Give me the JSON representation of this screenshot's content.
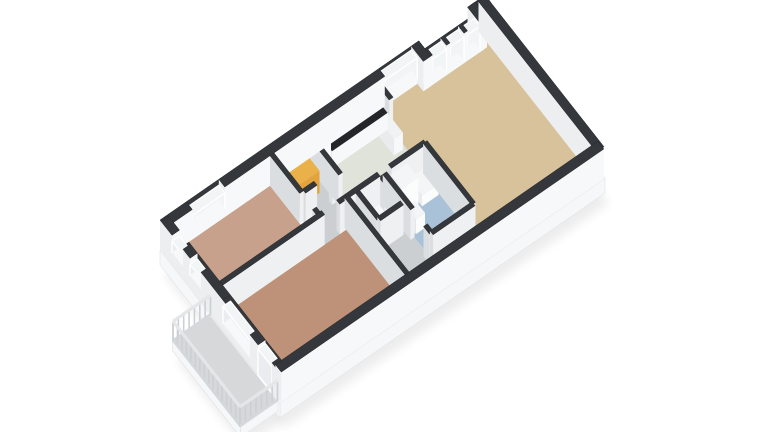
{
  "scene": {
    "width": 768,
    "height": 432,
    "origin": [
      160,
      250
    ],
    "ex": [
      25.0,
      -17.3
    ],
    "ey": [
      20.0,
      25.5
    ],
    "wall_height": 30,
    "colors": {
      "background": "#ffffff",
      "cap": "#34373b",
      "cap_stroke": "#26282b",
      "int_bright": "#eef0f2",
      "int_dim": "#dbdee0",
      "ext_bright": "#f7f8f9",
      "ext_dim": "#eceef0",
      "glass_bright": "#f2f5f6",
      "glass_dim": "#e9edef",
      "glass_frame": "#ffffff",
      "slab_top": "#ffffff",
      "slab_side": "#f6f7f8",
      "slab_edge": "#e2e3e5",
      "shadow": "#000000"
    }
  },
  "slabs": [
    {
      "n": "main-slab",
      "poly": [
        [
          0,
          0
        ],
        [
          10.2,
          0
        ],
        [
          10.2,
          0.45
        ],
        [
          12.45,
          0.45
        ],
        [
          12.45,
          0
        ],
        [
          13,
          0
        ],
        [
          13,
          6
        ],
        [
          0,
          6
        ]
      ],
      "depth": 15
    },
    {
      "n": "balcony-slab",
      "poly": [
        [
          -1.52,
          2.52
        ],
        [
          -0.02,
          2.52
        ],
        [
          -0.02,
          5.92
        ],
        [
          -1.52,
          5.92
        ]
      ],
      "depth": 10
    }
  ],
  "floors": [
    {
      "n": "floor-hallway",
      "r": [
        4.3,
        0.28,
        8.46,
        5.8
      ],
      "c": "#cbcfd2"
    },
    {
      "n": "floor-bedroom-1",
      "r": [
        0.3,
        0.3,
        4.16,
        2.6
      ],
      "c": "#c7a18b"
    },
    {
      "n": "floor-bedroom-2",
      "r": [
        0.3,
        2.76,
        5.24,
        5.78
      ],
      "c": "#bd9279"
    },
    {
      "n": "floor-kitchen",
      "r": [
        5.7,
        0.3,
        8.44,
        2.6
      ],
      "c": "#dfe3da"
    },
    {
      "n": "floor-wc",
      "r": [
        5.78,
        2.84,
        6.54,
        3.74
      ],
      "c": "#d6d9db"
    },
    {
      "n": "floor-bathroom",
      "r": [
        6.86,
        2.84,
        8.38,
        5.02
      ],
      "c": "#a9c2d8"
    },
    {
      "n": "floor-living-room",
      "r": [
        8.46,
        0.3,
        12.7,
        5.78
      ],
      "c": "#d8c29c"
    },
    {
      "n": "floor-balcony",
      "r": [
        -1.5,
        2.54,
        -0.04,
        5.9
      ],
      "c": "#d6d8da"
    }
  ],
  "walls": [
    {
      "n": "wall-back-a1",
      "a": [
        0,
        0.15
      ],
      "b": [
        1.05,
        0.15
      ],
      "t": 0.3,
      "ext": true
    },
    {
      "n": "wall-back-a2",
      "a": [
        2.35,
        0.15
      ],
      "b": [
        8.75,
        0.15
      ],
      "t": 0.3,
      "ext": true
    },
    {
      "n": "wall-back-a3",
      "a": [
        10.05,
        0.15
      ],
      "b": [
        10.35,
        0.15
      ],
      "t": 0.3,
      "ext": true
    },
    {
      "n": "wall-step-a",
      "a": [
        10.2,
        0.0
      ],
      "b": [
        10.2,
        0.6
      ],
      "t": 0.3,
      "ext": true
    },
    {
      "n": "wall-back-b0",
      "a": [
        10.2,
        0.45
      ],
      "b": [
        10.42,
        0.45
      ],
      "t": 0.3,
      "ext": true
    },
    {
      "n": "wall-back-b1",
      "a": [
        10.98,
        0.45
      ],
      "b": [
        11.12,
        0.45
      ],
      "t": 0.3,
      "ext": true
    },
    {
      "n": "wall-back-b2",
      "a": [
        11.68,
        0.45
      ],
      "b": [
        11.82,
        0.45
      ],
      "t": 0.3,
      "ext": true
    },
    {
      "n": "wall-back-b3",
      "a": [
        12.32,
        0.45
      ],
      "b": [
        12.5,
        0.45
      ],
      "t": 0.3,
      "ext": true
    },
    {
      "n": "wall-step-b",
      "a": [
        12.45,
        0.0
      ],
      "b": [
        12.45,
        0.6
      ],
      "t": 0.3,
      "ext": true
    },
    {
      "n": "wall-back-c",
      "a": [
        12.4,
        0.15
      ],
      "b": [
        13,
        0.15
      ],
      "t": 0.3,
      "ext": true
    },
    {
      "n": "wall-east-end",
      "a": [
        12.85,
        0.05
      ],
      "b": [
        12.85,
        5.95
      ],
      "t": 0.3,
      "ext": true
    },
    {
      "n": "wall-front",
      "a": [
        0.05,
        5.85
      ],
      "b": [
        12.95,
        5.85
      ],
      "t": 0.3,
      "ext": true
    },
    {
      "n": "wall-west-a",
      "a": [
        0.15,
        0.05
      ],
      "b": [
        0.15,
        0.6
      ],
      "t": 0.3,
      "ext": true
    },
    {
      "n": "wall-west-b",
      "a": [
        0.15,
        1.15
      ],
      "b": [
        0.15,
        1.5
      ],
      "t": 0.3,
      "ext": true
    },
    {
      "n": "wall-west-c",
      "a": [
        0.15,
        2.05
      ],
      "b": [
        0.15,
        3.15
      ],
      "t": 0.3,
      "ext": true
    },
    {
      "n": "wall-west-d",
      "a": [
        0.15,
        4.5
      ],
      "b": [
        0.15,
        4.9
      ],
      "t": 0.3,
      "ext": true
    },
    {
      "n": "wall-west-e",
      "a": [
        0.15,
        5.6
      ],
      "b": [
        0.15,
        5.95
      ],
      "t": 0.3,
      "ext": true
    },
    {
      "n": "wall-bedroom-sep-a",
      "a": [
        0.3,
        2.68
      ],
      "b": [
        4.38,
        2.68
      ],
      "t": 0.16
    },
    {
      "n": "wall-bedroom-sep-b",
      "a": [
        4.98,
        2.68
      ],
      "b": [
        5.32,
        2.68
      ],
      "t": 0.16
    },
    {
      "n": "wall-bedroom1-right-a",
      "a": [
        4.24,
        0.3
      ],
      "b": [
        4.24,
        1.78
      ],
      "t": 0.16
    },
    {
      "n": "wall-bedroom1-right-b",
      "a": [
        4.24,
        2.42
      ],
      "b": [
        4.24,
        2.68
      ],
      "t": 0.16
    },
    {
      "n": "wall-storage-front-a",
      "a": [
        4.32,
        1.8
      ],
      "b": [
        4.78,
        1.8
      ],
      "t": 0.16
    },
    {
      "n": "wall-storage-front-b",
      "a": [
        5.38,
        1.8
      ],
      "b": [
        5.62,
        1.8
      ],
      "t": 0.16
    },
    {
      "n": "wall-mid-a",
      "a": [
        5.62,
        0.3
      ],
      "b": [
        5.62,
        2.0
      ],
      "t": 0.16
    },
    {
      "n": "wall-mid-b",
      "a": [
        5.62,
        2.6
      ],
      "b": [
        5.62,
        2.76
      ],
      "t": 0.16
    },
    {
      "n": "wall-kitchen-front-a",
      "a": [
        5.32,
        2.68
      ],
      "b": [
        6.6,
        2.68
      ],
      "t": 0.16
    },
    {
      "n": "wall-kitchen-front-b",
      "a": [
        7.05,
        2.68
      ],
      "b": [
        8.46,
        2.68
      ],
      "t": 0.16
    },
    {
      "n": "wall-bedroom2-right",
      "a": [
        5.32,
        2.68
      ],
      "b": [
        5.32,
        5.85
      ],
      "t": 0.16
    },
    {
      "n": "wall-wc-left",
      "a": [
        5.7,
        2.76
      ],
      "b": [
        5.7,
        3.82
      ],
      "t": 0.16
    },
    {
      "n": "wall-wc-right-a",
      "a": [
        6.62,
        2.76
      ],
      "b": [
        6.62,
        3.05
      ],
      "t": 0.16
    },
    {
      "n": "wall-wc-right-b",
      "a": [
        6.62,
        3.6
      ],
      "b": [
        6.62,
        3.82
      ],
      "t": 0.16
    },
    {
      "n": "wall-wc-front",
      "a": [
        5.7,
        3.82
      ],
      "b": [
        6.62,
        3.82
      ],
      "t": 0.16
    },
    {
      "n": "wall-bath-left-a",
      "a": [
        6.78,
        2.76
      ],
      "b": [
        6.78,
        4.15
      ],
      "t": 0.16
    },
    {
      "n": "wall-bath-left-b",
      "a": [
        6.78,
        4.8
      ],
      "b": [
        6.78,
        5.1
      ],
      "t": 0.16
    },
    {
      "n": "wall-bath-front",
      "a": [
        6.78,
        5.1
      ],
      "b": [
        8.46,
        5.1
      ],
      "t": 0.16
    },
    {
      "n": "wall-living-stub",
      "a": [
        8.46,
        0.3
      ],
      "b": [
        8.46,
        0.98
      ],
      "t": 0.16
    },
    {
      "n": "wall-living-left",
      "a": [
        8.46,
        2.68
      ],
      "b": [
        8.46,
        5.1
      ],
      "t": 0.16
    }
  ],
  "windows": [
    {
      "n": "window-bedroom1-back",
      "a": [
        1.05,
        0.15
      ],
      "b": [
        2.35,
        0.15
      ],
      "t": 0.3,
      "sill": 9,
      "head": 24
    },
    {
      "n": "window-living-large",
      "a": [
        8.75,
        0.15
      ],
      "b": [
        10.05,
        0.15
      ],
      "t": 0.3,
      "sill": 5,
      "head": 26
    },
    {
      "n": "window-french-1",
      "a": [
        10.42,
        0.45
      ],
      "b": [
        10.98,
        0.45
      ],
      "t": 0.3,
      "sill": 3,
      "head": 26
    },
    {
      "n": "window-french-2",
      "a": [
        11.12,
        0.45
      ],
      "b": [
        11.68,
        0.45
      ],
      "t": 0.3,
      "sill": 3,
      "head": 26
    },
    {
      "n": "window-french-3",
      "a": [
        11.82,
        0.45
      ],
      "b": [
        12.32,
        0.45
      ],
      "t": 0.3,
      "sill": 3,
      "head": 26
    },
    {
      "n": "window-west-high-1",
      "a": [
        0.15,
        0.6
      ],
      "b": [
        0.15,
        1.15
      ],
      "t": 0.3,
      "sill": 13,
      "head": 24
    },
    {
      "n": "window-west-high-2",
      "a": [
        0.15,
        1.5
      ],
      "b": [
        0.15,
        2.05
      ],
      "t": 0.3,
      "sill": 13,
      "head": 24
    },
    {
      "n": "window-bedroom2-balcony",
      "a": [
        0.15,
        3.15
      ],
      "b": [
        0.15,
        4.5
      ],
      "t": 0.3,
      "sill": 7,
      "head": 24
    },
    {
      "n": "door-balcony-glass",
      "a": [
        0.15,
        4.9
      ],
      "b": [
        0.15,
        5.6
      ],
      "t": 0.3,
      "sill": 0,
      "head": 26
    }
  ],
  "fixtures": [
    {
      "n": "fixture-kitchen-tall-cabinet",
      "r": [
        5.72,
        0.32,
        6.12,
        0.9
      ],
      "h": 28,
      "top": "#f2f3f4",
      "br": "#fafbfc",
      "dm": "#e8eaec"
    },
    {
      "n": "fixture-kitchen-counter",
      "r": [
        6.12,
        0.32,
        8.34,
        0.95
      ],
      "h": 17,
      "top": "#232528",
      "br": "#f7f8f9",
      "dm": "#e9ebec"
    },
    {
      "n": "fixture-counter-return",
      "r": [
        7.98,
        0.95,
        8.34,
        1.72
      ],
      "h": 17,
      "top": "#f1f2f3",
      "br": "#f7f8f9",
      "dm": "#e9ebec"
    },
    {
      "n": "fixture-stovetop",
      "r": [
        6.3,
        0.42,
        7.0,
        0.88
      ],
      "z0": 17,
      "h": 0.4,
      "top": "#303236",
      "br": "#303236",
      "dm": "#303236"
    },
    {
      "n": "fixture-kitchen-sink",
      "r": [
        7.62,
        0.44,
        8.2,
        0.9
      ],
      "z0": 17,
      "h": 0.4,
      "top": "#eef0f2",
      "br": "#eef0f2",
      "dm": "#eef0f2"
    },
    {
      "n": "fixture-orange-wardrobe",
      "r": [
        4.5,
        0.85,
        5.3,
        1.35
      ],
      "h": 22,
      "top": "#eab049",
      "br": "#e2a33c",
      "dm": "#c8882c"
    },
    {
      "n": "fixture-wc-toilet",
      "r": [
        5.92,
        2.95,
        6.4,
        3.35
      ],
      "h": 10,
      "top": "#f6f7f8",
      "br": "#fdfdfe",
      "dm": "#ececee"
    },
    {
      "n": "fixture-shower-column",
      "r": [
        6.95,
        2.85,
        7.6,
        3.42
      ],
      "h": 28,
      "top": "#f4f5f6",
      "br": "#fbfcfc",
      "dm": "#e9ebed"
    },
    {
      "n": "fixture-bathtub",
      "r": [
        7.68,
        2.85,
        8.34,
        3.5
      ],
      "h": 11,
      "top": "#f4f5f6",
      "br": "#fbfcfc",
      "dm": "#e9ebed"
    },
    {
      "n": "fixture-washbasin",
      "r": [
        6.95,
        3.6,
        7.32,
        4.1
      ],
      "h": 15,
      "top": "#f4f5f6",
      "br": "#fbfcfc",
      "dm": "#e9ebed"
    },
    {
      "n": "fixture-bath-toilet",
      "r": [
        7.8,
        4.5,
        8.3,
        4.95
      ],
      "h": 10,
      "top": "#f6f7f8",
      "br": "#fdfdfe",
      "dm": "#ececee"
    }
  ],
  "railing": {
    "picket_height": 19,
    "rail_height": 20,
    "picket_gap": 0.23,
    "picket_color": "#ccd0d3",
    "rail_color": "#e4e6e8",
    "base_color": "#d5d8da",
    "segments": [
      {
        "n": "railing-back",
        "a": [
          -0.02,
          2.55
        ],
        "b": [
          -1.52,
          2.55
        ]
      },
      {
        "n": "railing-outer",
        "a": [
          -1.52,
          2.55
        ],
        "b": [
          -1.52,
          5.9
        ]
      },
      {
        "n": "railing-front",
        "a": [
          -1.52,
          5.9
        ],
        "b": [
          -0.02,
          5.9
        ]
      }
    ]
  }
}
